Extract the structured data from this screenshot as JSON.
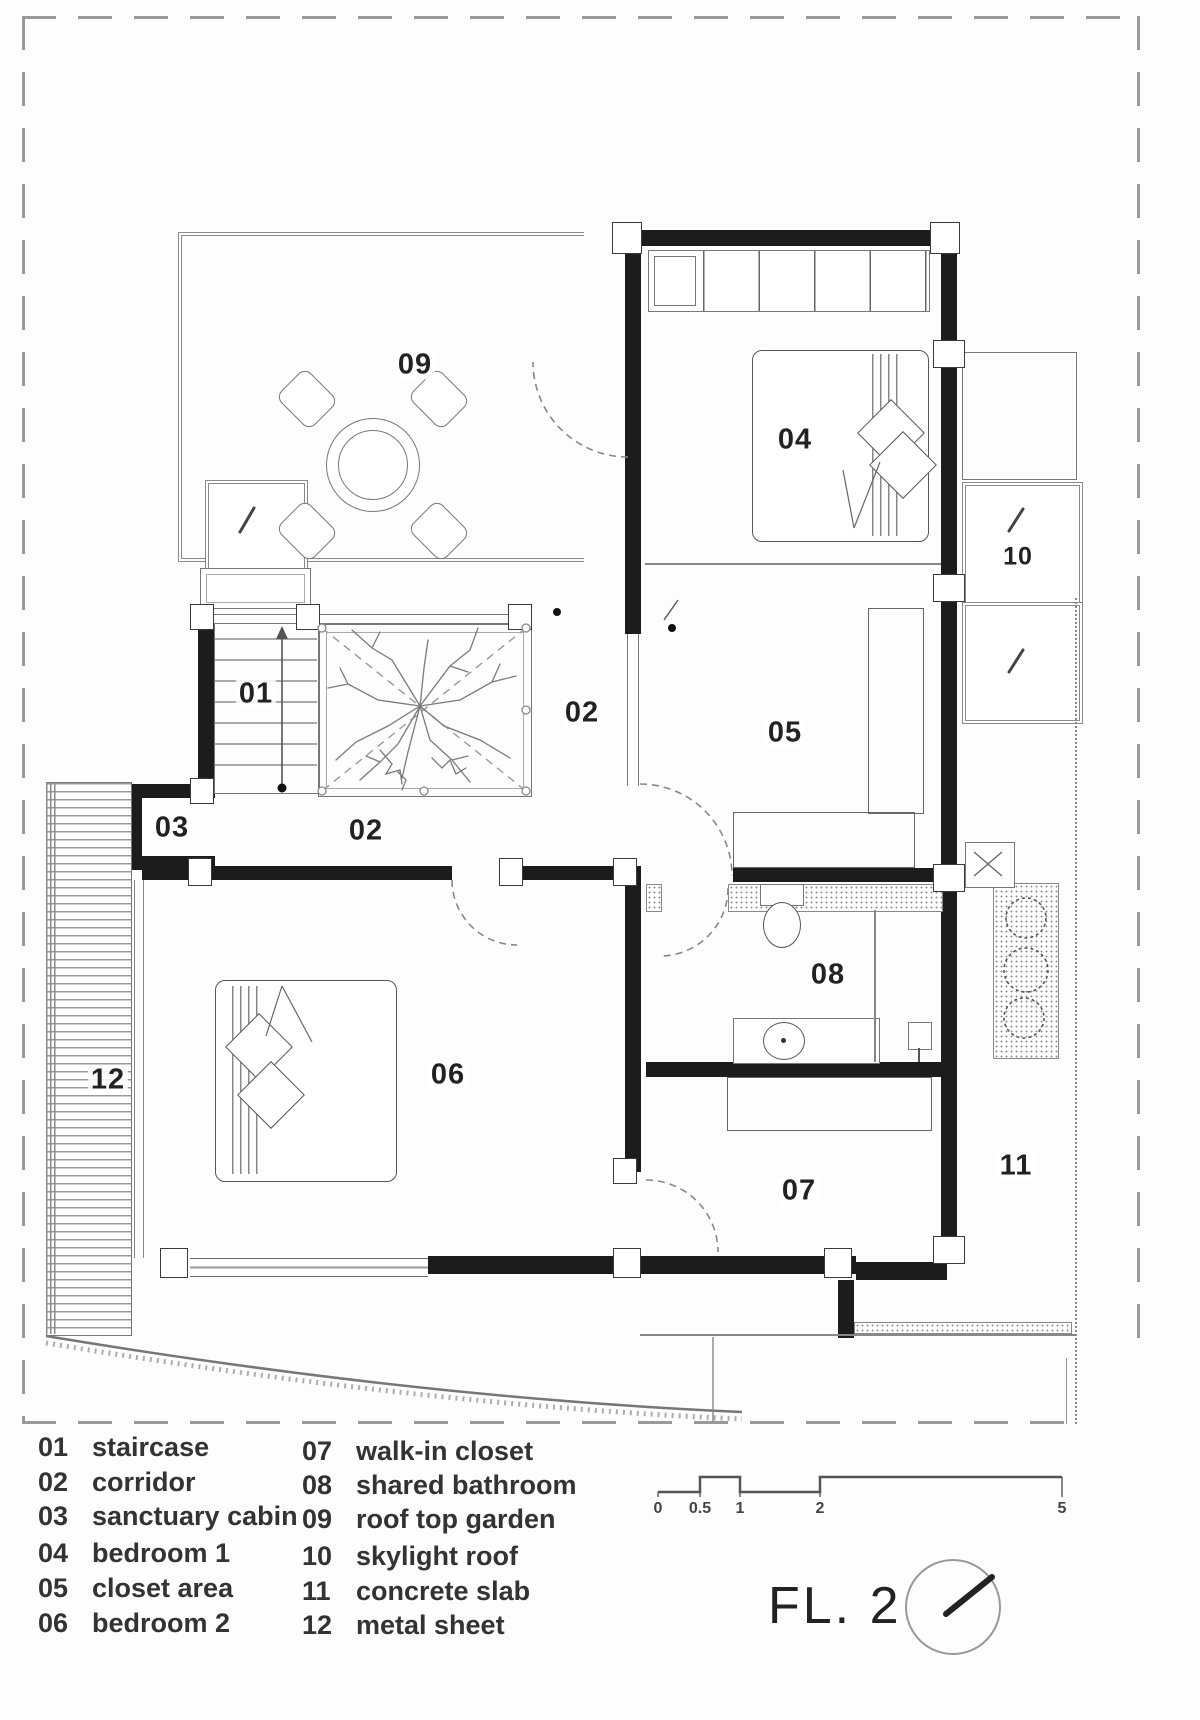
{
  "floor_label": "FL. 2",
  "rooms": {
    "r01": "01",
    "r02a": "02",
    "r02b": "02",
    "r03": "03",
    "r04": "04",
    "r05": "05",
    "r06": "06",
    "r07": "07",
    "r08": "08",
    "r09": "09",
    "r10": "10",
    "r11": "11",
    "r12": "12"
  },
  "legend": {
    "column1": [
      {
        "num": "01",
        "label": "staircase"
      },
      {
        "num": "02",
        "label": "corridor"
      },
      {
        "num": "03",
        "label": "sanctuary cabin"
      },
      {
        "num": "04",
        "label": "bedroom 1"
      },
      {
        "num": "05",
        "label": "closet area"
      },
      {
        "num": "06",
        "label": "bedroom 2"
      }
    ],
    "column2": [
      {
        "num": "07",
        "label": "walk-in closet"
      },
      {
        "num": "08",
        "label": "shared bathroom"
      },
      {
        "num": "09",
        "label": "roof top garden"
      },
      {
        "num": "10",
        "label": "skylight roof"
      },
      {
        "num": "11",
        "label": "concrete slab"
      },
      {
        "num": "12",
        "label": "metal sheet"
      }
    ]
  },
  "scale_bar": {
    "ticks": [
      "0",
      "0.5",
      "1",
      "2",
      "5"
    ]
  },
  "colors": {
    "wall": "#1c1c1c",
    "line": "#777777",
    "text": "#222222"
  }
}
